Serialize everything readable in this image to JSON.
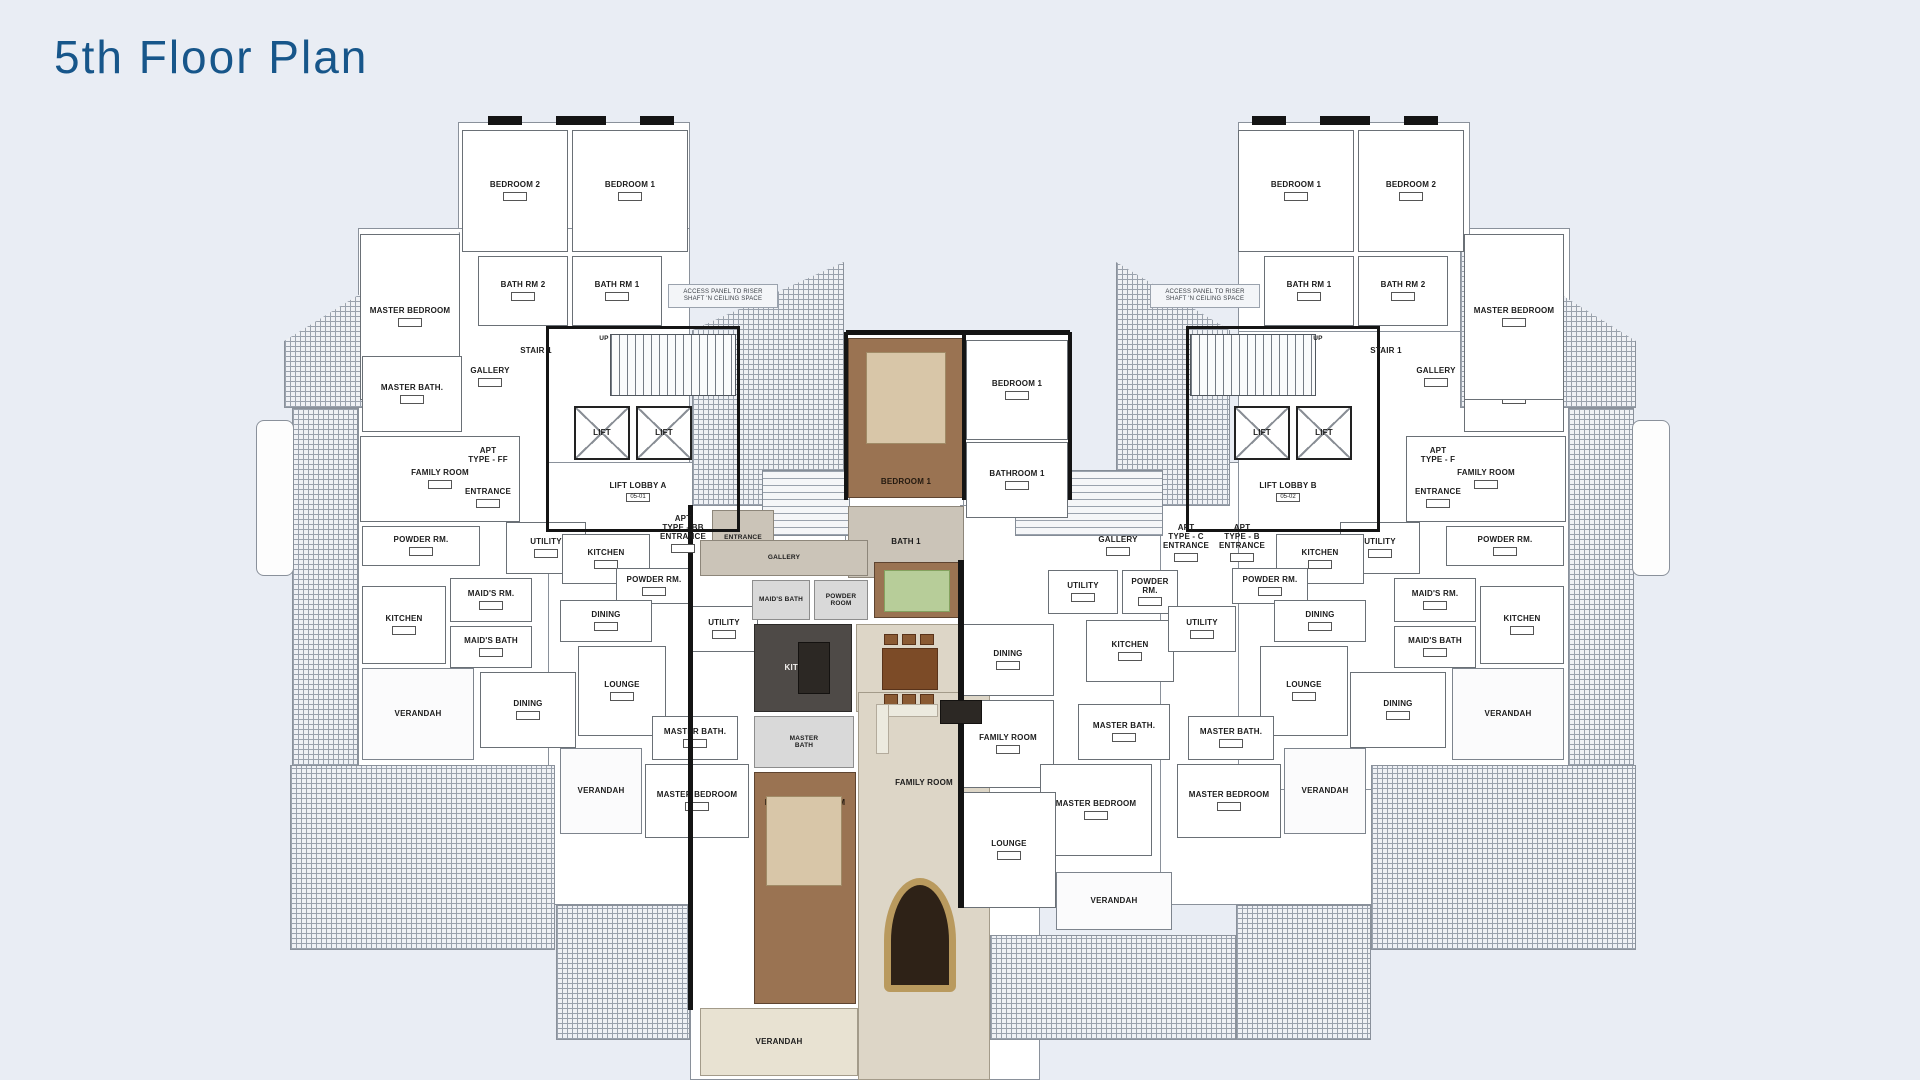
{
  "page": {
    "title": "5th Floor Plan",
    "title_color": "#17568a",
    "background": "#e9edf4"
  },
  "plan": {
    "rooms": [
      {
        "id": "bedroom-2-left",
        "label": "BEDROOM 2",
        "box": [
          462,
          130,
          106,
          122
        ],
        "cls": "",
        "chip": true
      },
      {
        "id": "bedroom-1-left",
        "label": "BEDROOM 1",
        "box": [
          572,
          130,
          116,
          122
        ],
        "cls": "",
        "chip": true
      },
      {
        "id": "bath-rm-2-left",
        "label": "BATH RM 2",
        "box": [
          478,
          256,
          90,
          70
        ],
        "cls": "",
        "chip": true
      },
      {
        "id": "bath-rm-1-left",
        "label": "BATH RM 1",
        "box": [
          572,
          256,
          90,
          70
        ],
        "cls": "",
        "chip": true
      },
      {
        "id": "master-bedroom-left-upper",
        "label": "MASTER BEDROOM",
        "box": [
          360,
          234,
          100,
          166
        ],
        "cls": "",
        "chip": true
      },
      {
        "id": "master-bath-left",
        "label": "MASTER BATH.",
        "box": [
          362,
          356,
          100,
          76
        ],
        "cls": "",
        "chip": true
      },
      {
        "id": "gallery-left",
        "label": "GALLERY",
        "box": [
          458,
          364,
          64,
          26
        ],
        "cls": "open",
        "chip": true
      },
      {
        "id": "stair-1-left-label",
        "label": "STAIR 1",
        "box": [
          506,
          344,
          60,
          14
        ],
        "cls": "open",
        "chip": false
      },
      {
        "id": "up-left",
        "label": "UP",
        "box": [
          592,
          334,
          24,
          10
        ],
        "cls": "open t6",
        "chip": false
      },
      {
        "id": "lift-1-left",
        "label": "LIFT",
        "box": [
          574,
          406,
          56,
          54
        ],
        "cls": "lift",
        "chip": false
      },
      {
        "id": "lift-2-left",
        "label": "LIFT",
        "box": [
          636,
          406,
          56,
          54
        ],
        "cls": "lift",
        "chip": false
      },
      {
        "id": "lift-lobby-a",
        "label": "LIFT LOBBY A",
        "code": "05-01",
        "box": [
          548,
          464,
          180,
          56
        ],
        "cls": "open",
        "chip": true
      },
      {
        "id": "apt-type-ff",
        "label": "APT\nTYPE - FF",
        "box": [
          450,
          438,
          76,
          36
        ],
        "cls": "open",
        "chip": false
      },
      {
        "id": "apt-ff-entrance",
        "label": "ENTRANCE",
        "box": [
          450,
          488,
          76,
          20
        ],
        "cls": "open",
        "chip": true
      },
      {
        "id": "family-room-left",
        "label": "FAMILY ROOM",
        "box": [
          360,
          436,
          160,
          86
        ],
        "cls": "",
        "chip": true
      },
      {
        "id": "powder-rm-left",
        "label": "POWDER RM.",
        "box": [
          362,
          526,
          118,
          40
        ],
        "cls": "",
        "chip": true
      },
      {
        "id": "utility-left",
        "label": "UTILITY",
        "box": [
          506,
          522,
          80,
          52
        ],
        "cls": "",
        "chip": true
      },
      {
        "id": "kitchen-left",
        "label": "KITCHEN",
        "box": [
          362,
          586,
          84,
          78
        ],
        "cls": "",
        "chip": true
      },
      {
        "id": "maids-rm-left",
        "label": "MAID'S RM.",
        "box": [
          450,
          578,
          82,
          44
        ],
        "cls": "",
        "chip": true
      },
      {
        "id": "maids-bath-left",
        "label": "MAID'S BATH",
        "box": [
          450,
          626,
          82,
          42
        ],
        "cls": "",
        "chip": true
      },
      {
        "id": "dining-left",
        "label": "DINING",
        "box": [
          480,
          672,
          96,
          76
        ],
        "cls": "",
        "chip": true
      },
      {
        "id": "verandah-left",
        "label": "VERANDAH",
        "box": [
          362,
          668,
          112,
          92
        ],
        "cls": "verandah",
        "chip": false
      },
      {
        "id": "kitchen-bb",
        "label": "KITCHEN",
        "box": [
          562,
          534,
          88,
          50
        ],
        "cls": "",
        "chip": true
      },
      {
        "id": "powder-rm-bb",
        "label": "POWDER RM.",
        "box": [
          616,
          568,
          76,
          36
        ],
        "cls": "",
        "chip": true
      },
      {
        "id": "dining-bb",
        "label": "DINING",
        "box": [
          560,
          600,
          92,
          42
        ],
        "cls": "",
        "chip": true
      },
      {
        "id": "utility-bb",
        "label": "UTILITY",
        "box": [
          690,
          606,
          68,
          46
        ],
        "cls": "",
        "chip": true
      },
      {
        "id": "lounge-bb",
        "label": "LOUNGE",
        "box": [
          578,
          646,
          88,
          90
        ],
        "cls": "",
        "chip": true
      },
      {
        "id": "master-bath-bb",
        "label": "MASTER BATH.",
        "box": [
          652,
          716,
          86,
          44
        ],
        "cls": "",
        "chip": true
      },
      {
        "id": "master-bedroom-bb",
        "label": "MASTER BEDROOM",
        "box": [
          645,
          764,
          104,
          74
        ],
        "cls": "",
        "chip": true
      },
      {
        "id": "verandah-bb",
        "label": "VERANDAH",
        "box": [
          560,
          748,
          82,
          86
        ],
        "cls": "verandah",
        "chip": false
      },
      {
        "id": "apt-bb-entrance",
        "label": "APT\nTYPE - BB\nENTRANCE",
        "box": [
          648,
          510,
          70,
          48
        ],
        "cls": "open",
        "chip": true
      },
      {
        "id": "bedroom-1-featured",
        "label": "BEDROOM 1",
        "box": [
          848,
          338,
          116,
          160
        ],
        "cls": "brown lb-bottom",
        "chip": false
      },
      {
        "id": "bath-1-featured",
        "label": "BATH 1",
        "box": [
          848,
          506,
          116,
          72
        ],
        "cls": "taupe",
        "chip": false
      },
      {
        "id": "entrance-featured",
        "label": "ENTRANCE",
        "box": [
          712,
          510,
          62,
          56
        ],
        "cls": "taupe t6",
        "chip": false
      },
      {
        "id": "gallery-featured",
        "label": "GALLERY",
        "box": [
          700,
          540,
          168,
          36
        ],
        "cls": "taupe t6",
        "chip": false
      },
      {
        "id": "maids-bath-featured",
        "label": "MAID'S BATH",
        "box": [
          752,
          580,
          58,
          40
        ],
        "cls": "gray t6",
        "chip": false
      },
      {
        "id": "powder-room-featured",
        "label": "POWDER\nROOM",
        "box": [
          814,
          580,
          54,
          40
        ],
        "cls": "gray t6",
        "chip": false
      },
      {
        "id": "maids-rm-featured",
        "label": "MAID'S RM",
        "box": [
          874,
          562,
          90,
          56
        ],
        "cls": "brown t6 lb-bottom",
        "chip": false
      },
      {
        "id": "kitchen-featured",
        "label": "KITCHEN",
        "box": [
          754,
          624,
          98,
          88
        ],
        "cls": "dark",
        "chip": false
      },
      {
        "id": "dining-featured",
        "label": "DINING",
        "box": [
          856,
          624,
          108,
          88
        ],
        "cls": "beige",
        "chip": false
      },
      {
        "id": "master-bath-featured",
        "label": "MASTER\nBATH",
        "box": [
          754,
          716,
          100,
          52
        ],
        "cls": "gray t6",
        "chip": false
      },
      {
        "id": "master-bedroom-featured",
        "label": "MASTER BEDROOM",
        "box": [
          754,
          772,
          102,
          232
        ],
        "cls": "brown lb-top",
        "chip": false
      },
      {
        "id": "family-room-featured",
        "label": "FAMILY ROOM",
        "box": [
          858,
          692,
          132,
          388
        ],
        "cls": "beige lb-fam",
        "chip": false
      },
      {
        "id": "verandah-featured",
        "label": "VERANDAH",
        "box": [
          700,
          1008,
          158,
          68
        ],
        "cls": "verandah-b",
        "chip": false
      },
      {
        "id": "bedroom-1-c",
        "label": "BEDROOM 1",
        "box": [
          966,
          340,
          102,
          100
        ],
        "cls": "",
        "chip": true
      },
      {
        "id": "bathroom-1-c",
        "label": "BATHROOM 1",
        "box": [
          966,
          442,
          102,
          76
        ],
        "cls": "",
        "chip": true
      },
      {
        "id": "gallery-c",
        "label": "GALLERY",
        "box": [
          1062,
          528,
          112,
          36
        ],
        "cls": "open",
        "chip": true
      },
      {
        "id": "utility-c",
        "label": "UTILITY",
        "box": [
          1048,
          570,
          70,
          44
        ],
        "cls": "",
        "chip": true
      },
      {
        "id": "powder-rm-c",
        "label": "POWDER RM.",
        "box": [
          1122,
          570,
          56,
          44
        ],
        "cls": "",
        "chip": true
      },
      {
        "id": "kitchen-c",
        "label": "KITCHEN",
        "box": [
          1086,
          620,
          88,
          62
        ],
        "cls": "",
        "chip": true
      },
      {
        "id": "dining-c",
        "label": "DINING",
        "box": [
          962,
          624,
          92,
          72
        ],
        "cls": "",
        "chip": true
      },
      {
        "id": "family-room-c",
        "label": "FAMILY ROOM",
        "box": [
          962,
          700,
          92,
          88
        ],
        "cls": "",
        "chip": true
      },
      {
        "id": "master-bath-c",
        "label": "MASTER BATH.",
        "box": [
          1078,
          704,
          92,
          56
        ],
        "cls": "",
        "chip": true
      },
      {
        "id": "master-bedroom-c",
        "label": "MASTER BEDROOM",
        "box": [
          1040,
          764,
          112,
          92
        ],
        "cls": "",
        "chip": true
      },
      {
        "id": "lounge-c",
        "label": "LOUNGE",
        "box": [
          962,
          792,
          94,
          116
        ],
        "cls": "",
        "chip": true
      },
      {
        "id": "verandah-c",
        "label": "VERANDAH",
        "box": [
          1056,
          872,
          116,
          58
        ],
        "cls": "verandah",
        "chip": false
      },
      {
        "id": "apt-c-entrance",
        "label": "APT\nTYPE - C\nENTRANCE",
        "box": [
          1152,
          518,
          68,
          50
        ],
        "cls": "open",
        "chip": true
      },
      {
        "id": "apt-b-entrance",
        "label": "APT\nTYPE - B\nENTRANCE",
        "box": [
          1208,
          518,
          68,
          50
        ],
        "cls": "open",
        "chip": true
      },
      {
        "id": "stair-1-right-label",
        "label": "STAIR 1",
        "box": [
          1356,
          344,
          60,
          14
        ],
        "cls": "open",
        "chip": false
      },
      {
        "id": "up-right",
        "label": "UP",
        "box": [
          1306,
          334,
          24,
          10
        ],
        "cls": "open t6",
        "chip": false
      },
      {
        "id": "lift-1-right",
        "label": "LIFT",
        "box": [
          1234,
          406,
          56,
          54
        ],
        "cls": "lift",
        "chip": false
      },
      {
        "id": "lift-2-right",
        "label": "LIFT",
        "box": [
          1296,
          406,
          56,
          54
        ],
        "cls": "lift",
        "chip": false
      },
      {
        "id": "lift-lobby-b",
        "label": "LIFT LOBBY B",
        "code": "05-02",
        "box": [
          1198,
          464,
          180,
          56
        ],
        "cls": "open",
        "chip": true
      },
      {
        "id": "gallery-right",
        "label": "GALLERY",
        "box": [
          1404,
          364,
          64,
          26
        ],
        "cls": "open",
        "chip": true
      },
      {
        "id": "master-bath-right",
        "label": "MASTER BATH.",
        "box": [
          1464,
          356,
          100,
          76
        ],
        "cls": "",
        "chip": true
      },
      {
        "id": "apt-type-f",
        "label": "APT\nTYPE - F",
        "box": [
          1400,
          438,
          76,
          36
        ],
        "cls": "open",
        "chip": false
      },
      {
        "id": "apt-f-entrance",
        "label": "ENTRANCE",
        "box": [
          1400,
          488,
          76,
          20
        ],
        "cls": "open",
        "chip": true
      },
      {
        "id": "master-bedroom-right-upper",
        "label": "MASTER BEDROOM",
        "box": [
          1464,
          234,
          100,
          166
        ],
        "cls": "",
        "chip": true
      },
      {
        "id": "bedroom-1-right",
        "label": "BEDROOM 1",
        "box": [
          1238,
          130,
          116,
          122
        ],
        "cls": "",
        "chip": true
      },
      {
        "id": "bedroom-2-right",
        "label": "BEDROOM 2",
        "box": [
          1358,
          130,
          106,
          122
        ],
        "cls": "",
        "chip": true
      },
      {
        "id": "bath-rm-1-right",
        "label": "BATH RM 1",
        "box": [
          1264,
          256,
          90,
          70
        ],
        "cls": "",
        "chip": true
      },
      {
        "id": "bath-rm-2-right",
        "label": "BATH RM 2",
        "box": [
          1358,
          256,
          90,
          70
        ],
        "cls": "",
        "chip": true
      },
      {
        "id": "family-room-right",
        "label": "FAMILY ROOM",
        "box": [
          1406,
          436,
          160,
          86
        ],
        "cls": "",
        "chip": true
      },
      {
        "id": "powder-rm-right",
        "label": "POWDER RM.",
        "box": [
          1446,
          526,
          118,
          40
        ],
        "cls": "",
        "chip": true
      },
      {
        "id": "utility-right",
        "label": "UTILITY",
        "box": [
          1340,
          522,
          80,
          52
        ],
        "cls": "",
        "chip": true
      },
      {
        "id": "kitchen-right",
        "label": "KITCHEN",
        "box": [
          1480,
          586,
          84,
          78
        ],
        "cls": "",
        "chip": true
      },
      {
        "id": "maids-rm-right",
        "label": "MAID'S RM.",
        "box": [
          1394,
          578,
          82,
          44
        ],
        "cls": "",
        "chip": true
      },
      {
        "id": "maids-bath-right",
        "label": "MAID'S BATH",
        "box": [
          1394,
          626,
          82,
          42
        ],
        "cls": "",
        "chip": true
      },
      {
        "id": "dining-right",
        "label": "DINING",
        "box": [
          1350,
          672,
          96,
          76
        ],
        "cls": "",
        "chip": true
      },
      {
        "id": "verandah-right",
        "label": "VERANDAH",
        "box": [
          1452,
          668,
          112,
          92
        ],
        "cls": "verandah",
        "chip": false
      },
      {
        "id": "kitchen-b",
        "label": "KITCHEN",
        "box": [
          1276,
          534,
          88,
          50
        ],
        "cls": "",
        "chip": true
      },
      {
        "id": "powder-rm-b",
        "label": "POWDER RM.",
        "box": [
          1232,
          568,
          76,
          36
        ],
        "cls": "",
        "chip": true
      },
      {
        "id": "dining-b",
        "label": "DINING",
        "box": [
          1274,
          600,
          92,
          42
        ],
        "cls": "",
        "chip": true
      },
      {
        "id": "utility-b",
        "label": "UTILITY",
        "box": [
          1168,
          606,
          68,
          46
        ],
        "cls": "",
        "chip": true
      },
      {
        "id": "lounge-b",
        "label": "LOUNGE",
        "box": [
          1260,
          646,
          88,
          90
        ],
        "cls": "",
        "chip": true
      },
      {
        "id": "master-bath-b",
        "label": "MASTER BATH.",
        "box": [
          1188,
          716,
          86,
          44
        ],
        "cls": "",
        "chip": true
      },
      {
        "id": "master-bedroom-b",
        "label": "MASTER BEDROOM",
        "box": [
          1177,
          764,
          104,
          74
        ],
        "cls": "",
        "chip": true
      },
      {
        "id": "verandah-b",
        "label": "VERANDAH",
        "box": [
          1284,
          748,
          82,
          86
        ],
        "cls": "verandah",
        "chip": false
      },
      {
        "id": "access-note-left",
        "label": "ACCESS PANEL TO RISER\nSHAFT 'N CEILING SPACE",
        "box": [
          668,
          284,
          110,
          24
        ],
        "cls": "note",
        "chip": false
      },
      {
        "id": "access-note-right",
        "label": "ACCESS PANEL TO RISER\nSHAFT 'N CEILING SPACE",
        "box": [
          1150,
          284,
          110,
          24
        ],
        "cls": "note",
        "chip": false
      }
    ]
  }
}
